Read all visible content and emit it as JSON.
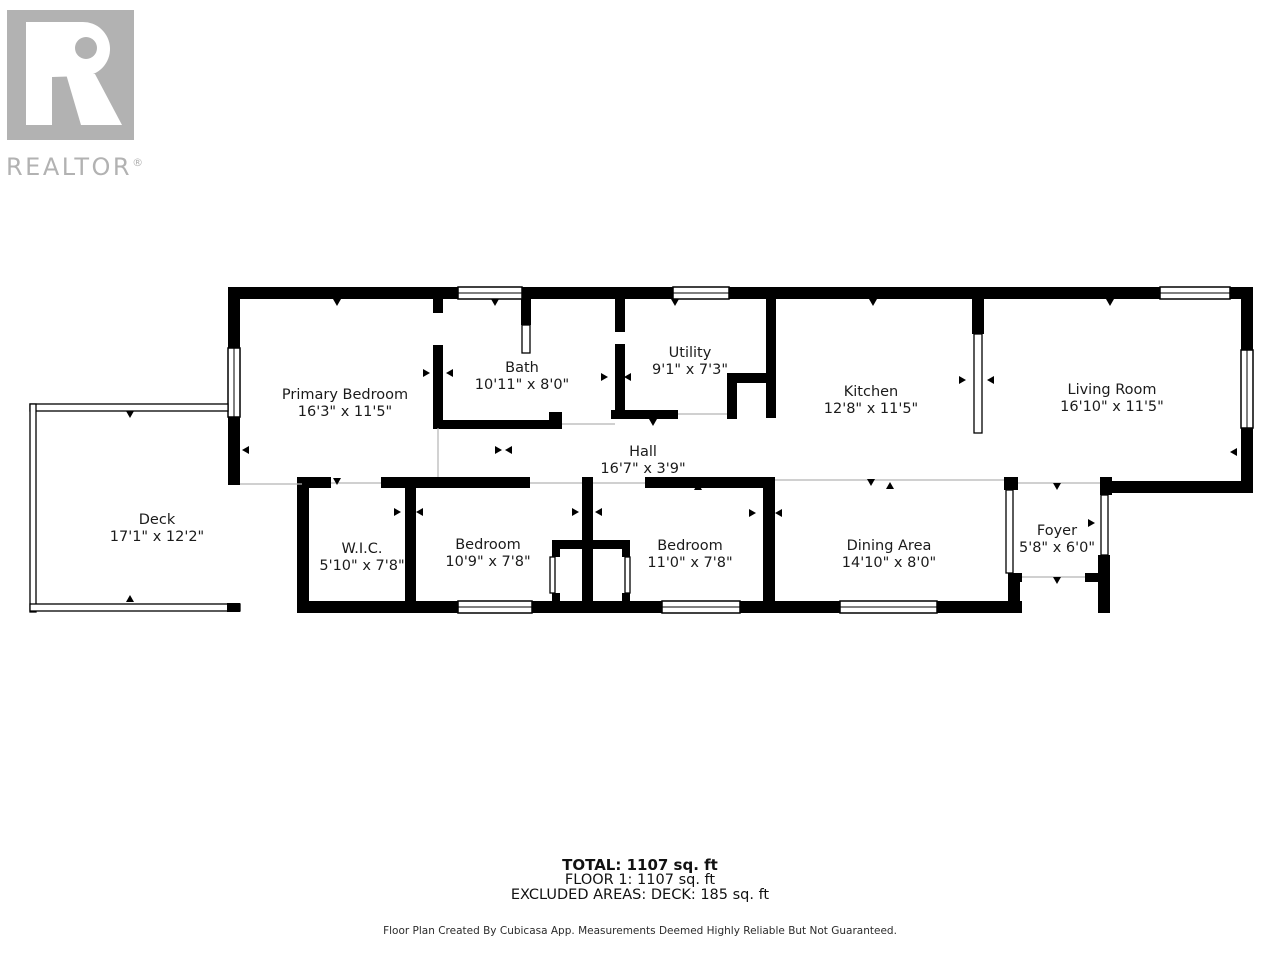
{
  "logo": {
    "wordmark": "REALTOR",
    "registered": "®",
    "color": "#b2b2b2"
  },
  "rooms": [
    {
      "id": "primary-bedroom",
      "name": "Primary Bedroom",
      "dims": "16'3\" x 11'5\""
    },
    {
      "id": "bath",
      "name": "Bath",
      "dims": "10'11\" x 8'0\""
    },
    {
      "id": "utility",
      "name": "Utility",
      "dims": "9'1\" x 7'3\""
    },
    {
      "id": "kitchen",
      "name": "Kitchen",
      "dims": "12'8\" x 11'5\""
    },
    {
      "id": "living-room",
      "name": "Living Room",
      "dims": "16'10\" x 11'5\""
    },
    {
      "id": "hall",
      "name": "Hall",
      "dims": "16'7\" x 3'9\""
    },
    {
      "id": "deck",
      "name": "Deck",
      "dims": "17'1\" x 12'2\""
    },
    {
      "id": "wic",
      "name": "W.I.C.",
      "dims": "5'10\" x 7'8\""
    },
    {
      "id": "bedroom-1",
      "name": "Bedroom",
      "dims": "10'9\" x 7'8\""
    },
    {
      "id": "bedroom-2",
      "name": "Bedroom",
      "dims": "11'0\" x 7'8\""
    },
    {
      "id": "dining-area",
      "name": "Dining Area",
      "dims": "14'10\" x 8'0\""
    },
    {
      "id": "foyer",
      "name": "Foyer",
      "dims": "5'8\" x 6'0\""
    }
  ],
  "summary": {
    "total": "TOTAL: 1107 sq. ft",
    "floor": "FLOOR 1: 1107 sq. ft",
    "excluded": "EXCLUDED AREAS: DECK: 185 sq. ft"
  },
  "disclaimer": "Floor Plan Created By Cubicasa App. Measurements Deemed Highly Reliable But Not Guaranteed.",
  "wall_color": "#000000"
}
